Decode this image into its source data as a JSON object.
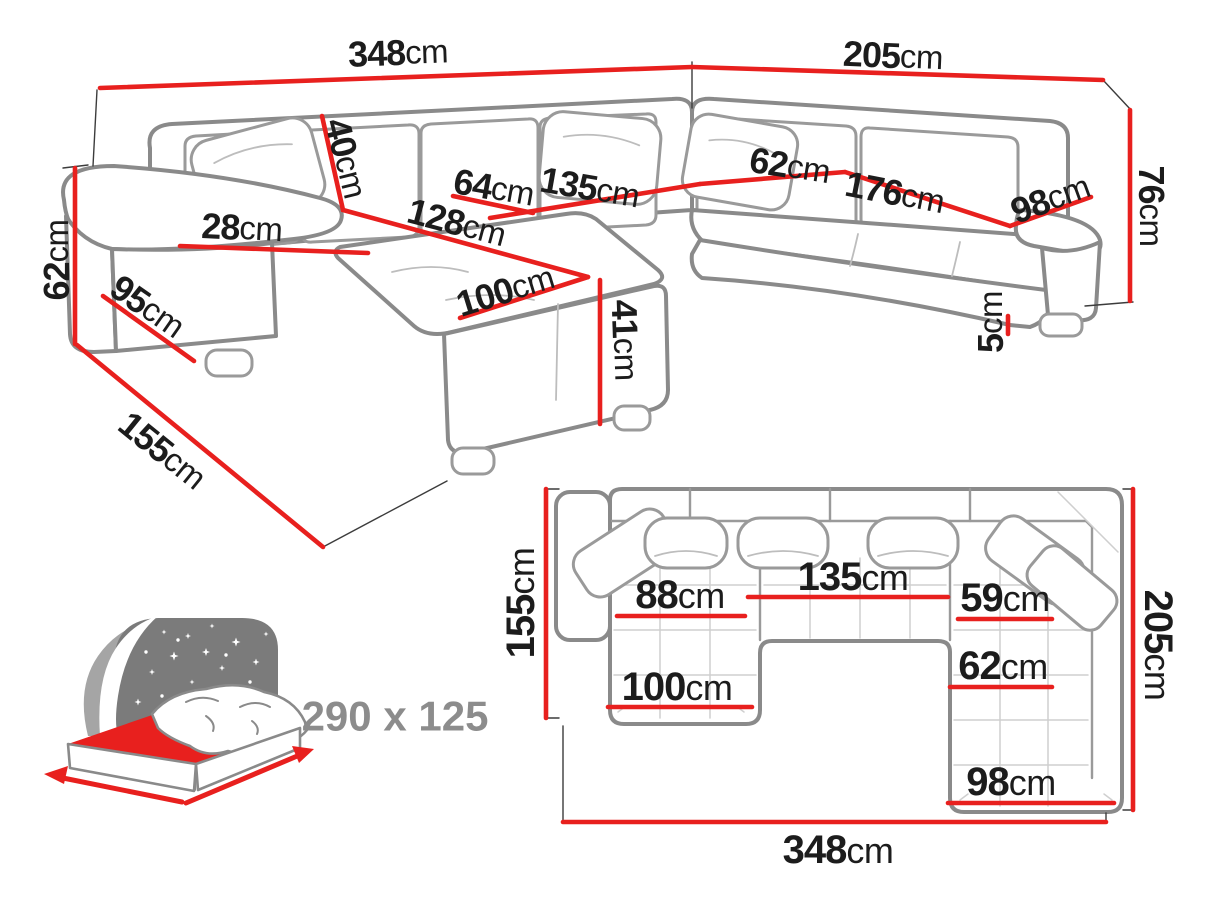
{
  "diagram_title": "U-shaped corner sofa bed dimension diagram",
  "colors": {
    "dimension_line_red": "#e8201e",
    "sofa_outline_gray": "#8a8a8a",
    "label_text": "#1c1c1c",
    "icon_panel_gray": "#7b7b7b",
    "sleeping_size_text_gray": "#8c8c8c"
  },
  "perspective_view": {
    "description": "3D perspective view of U-shaped sectional sofa",
    "dimensions": [
      {
        "name": "total-width-left-section",
        "value": "348",
        "unit": "cm"
      },
      {
        "name": "total-width-right-section",
        "value": "205",
        "unit": "cm"
      },
      {
        "name": "back-height",
        "value": "76",
        "unit": "cm"
      },
      {
        "name": "armrest-height",
        "value": "62",
        "unit": "cm"
      },
      {
        "name": "armrest-side-depth",
        "value": "95",
        "unit": "cm"
      },
      {
        "name": "side-floor-depth",
        "value": "155",
        "unit": "cm"
      },
      {
        "name": "armrest-width",
        "value": "28",
        "unit": "cm"
      },
      {
        "name": "back-cushion-height",
        "value": "40",
        "unit": "cm"
      },
      {
        "name": "seat-depth-left",
        "value": "64",
        "unit": "cm"
      },
      {
        "name": "middle-seat-width",
        "value": "135",
        "unit": "cm"
      },
      {
        "name": "seat-depth-right",
        "value": "62",
        "unit": "cm"
      },
      {
        "name": "right-seat-length",
        "value": "176",
        "unit": "cm"
      },
      {
        "name": "right-end-width",
        "value": "98",
        "unit": "cm"
      },
      {
        "name": "chaise-length",
        "value": "128",
        "unit": "cm"
      },
      {
        "name": "chaise-width",
        "value": "100",
        "unit": "cm"
      },
      {
        "name": "seat-height",
        "value": "41",
        "unit": "cm"
      },
      {
        "name": "leg-height",
        "value": "5",
        "unit": "cm"
      }
    ]
  },
  "sleeping_area": {
    "icon": "bed-icon",
    "size_label": "290 x 125"
  },
  "plan_view": {
    "description": "Top-down plan view of U-shaped sectional sofa",
    "dimensions": [
      {
        "name": "plan-left-depth",
        "value": "155",
        "unit": "cm"
      },
      {
        "name": "plan-right-depth",
        "value": "205",
        "unit": "cm"
      },
      {
        "name": "plan-total-width",
        "value": "348",
        "unit": "cm"
      },
      {
        "name": "plan-left-seat-width",
        "value": "88",
        "unit": "cm"
      },
      {
        "name": "plan-middle-seat-width",
        "value": "135",
        "unit": "cm"
      },
      {
        "name": "plan-right-upper-width",
        "value": "59",
        "unit": "cm"
      },
      {
        "name": "plan-right-seat-width",
        "value": "62",
        "unit": "cm"
      },
      {
        "name": "plan-left-chaise-width",
        "value": "100",
        "unit": "cm"
      },
      {
        "name": "plan-bottom-chaise-width",
        "value": "98",
        "unit": "cm"
      }
    ]
  }
}
